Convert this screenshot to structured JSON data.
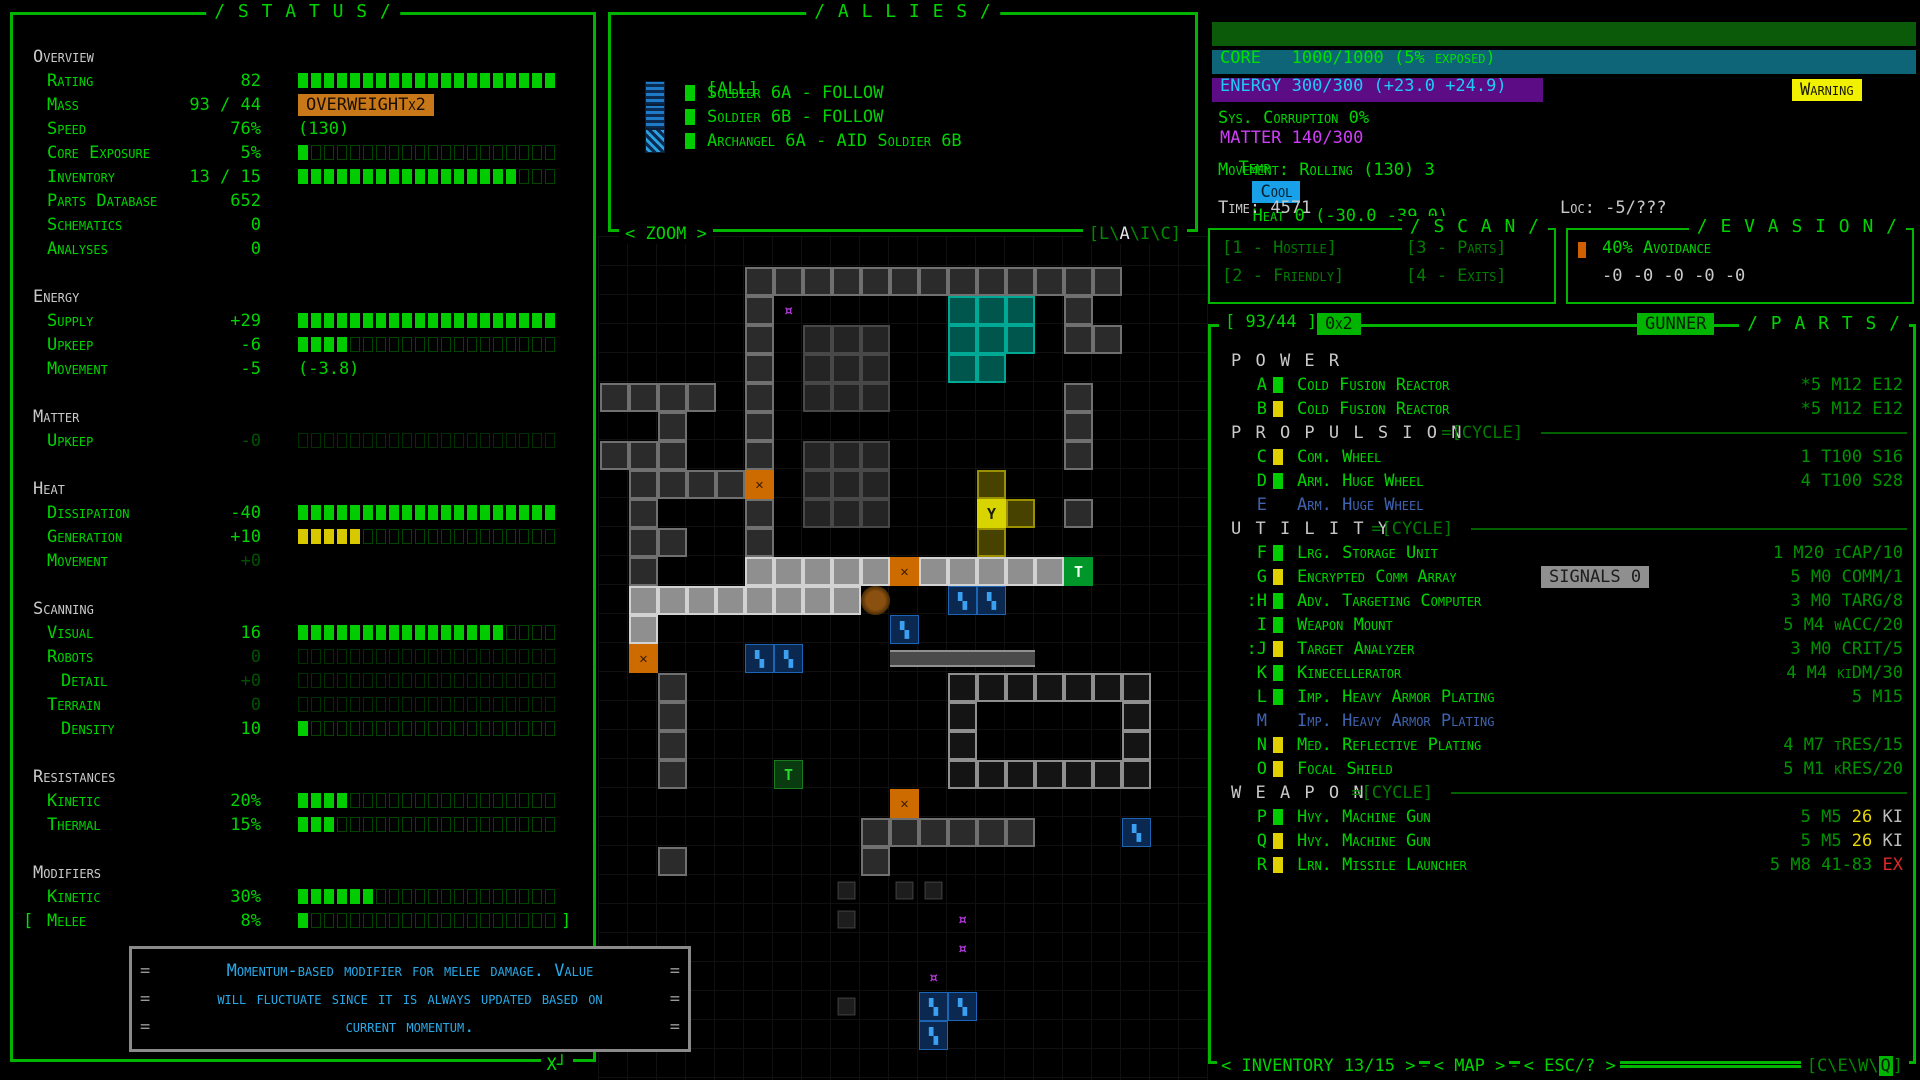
{
  "status": {
    "title": "/ S T A T U S /",
    "close_label": "X┘",
    "rows": [
      {
        "type": "header",
        "label": "Overview"
      },
      {
        "type": "stat",
        "label": "Rating",
        "value": "82",
        "bar": {
          "filled": 20,
          "color": "green"
        }
      },
      {
        "type": "stat",
        "label": "Mass",
        "value": "93 / 44",
        "badge": {
          "text": "OVERWEIGHTx2",
          "style": "orange"
        }
      },
      {
        "type": "stat",
        "label": "Speed",
        "value": "76%",
        "suffix": "(130)"
      },
      {
        "type": "stat",
        "label": "Core Exposure",
        "value": "5%",
        "bar": {
          "filled": 1,
          "color": "green"
        }
      },
      {
        "type": "stat",
        "label": "Inventory",
        "value": "13 / 15",
        "bar": {
          "filled": 17,
          "color": "green"
        }
      },
      {
        "type": "stat",
        "label": "Parts Database",
        "value": "652"
      },
      {
        "type": "stat",
        "label": "Schematics",
        "value": "0"
      },
      {
        "type": "stat",
        "label": "Analyses",
        "value": "0"
      },
      {
        "type": "gap"
      },
      {
        "type": "header",
        "label": "Energy"
      },
      {
        "type": "stat",
        "label": "Supply",
        "value": "+29",
        "bar": {
          "filled": 20,
          "color": "green"
        }
      },
      {
        "type": "stat",
        "label": "Upkeep",
        "value": "-6",
        "bar": {
          "filled": 4,
          "color": "green"
        }
      },
      {
        "type": "stat",
        "label": "Movement",
        "value": "-5",
        "suffix": "(-3.8)"
      },
      {
        "type": "gap"
      },
      {
        "type": "header",
        "label": "Matter"
      },
      {
        "type": "stat",
        "label": "Upkeep",
        "value": "-0",
        "dimval": true,
        "bar": {
          "filled": 0,
          "color": "green",
          "dim": true
        }
      },
      {
        "type": "gap"
      },
      {
        "type": "header",
        "label": "Heat"
      },
      {
        "type": "stat",
        "label": "Dissipation",
        "value": "-40",
        "bar": {
          "filled": 20,
          "color": "green"
        }
      },
      {
        "type": "stat",
        "label": "Generation",
        "value": "+10",
        "bar": {
          "filled": 5,
          "color": "yellow"
        }
      },
      {
        "type": "stat",
        "label": "Movement",
        "value": "+0",
        "dimval": true
      },
      {
        "type": "gap"
      },
      {
        "type": "header",
        "label": "Scanning"
      },
      {
        "type": "stat",
        "label": "Visual",
        "value": "16",
        "bar": {
          "filled": 16,
          "color": "green"
        }
      },
      {
        "type": "stat",
        "label": "Robots",
        "value": "0",
        "dimval": true,
        "bar": {
          "filled": 0,
          "color": "green",
          "dim": true
        }
      },
      {
        "type": "stat",
        "label": "Detail",
        "indent": true,
        "value": "+0",
        "dimval": true,
        "bar": {
          "filled": 0,
          "color": "green",
          "dim": true
        }
      },
      {
        "type": "stat",
        "label": "Terrain",
        "value": "0",
        "dimval": true,
        "bar": {
          "filled": 0,
          "color": "green",
          "dim": true
        }
      },
      {
        "type": "stat",
        "label": "Density",
        "indent": true,
        "value": "10",
        "bar": {
          "filled": 1,
          "color": "green"
        }
      },
      {
        "type": "gap"
      },
      {
        "type": "header",
        "label": "Resistances"
      },
      {
        "type": "stat",
        "label": "Kinetic",
        "value": "20%",
        "bar": {
          "filled": 4,
          "color": "green"
        }
      },
      {
        "type": "stat",
        "label": "Thermal",
        "value": "15%",
        "bar": {
          "filled": 3,
          "color": "green"
        }
      },
      {
        "type": "gap"
      },
      {
        "type": "header",
        "label": "Modifiers"
      },
      {
        "type": "stat",
        "label": "Kinetic",
        "value": "30%",
        "bar": {
          "filled": 6,
          "color": "green"
        }
      },
      {
        "type": "stat",
        "label": "Melee",
        "value": "8%",
        "bar": {
          "filled": 1,
          "color": "green"
        },
        "bracketed": true
      }
    ],
    "tooltip": {
      "tick": "=",
      "lines": [
        "Momentum-based modifier for melee damage. Value",
        "will fluctuate since it is always updated based on",
        "current momentum."
      ]
    }
  },
  "allies": {
    "title": "/ A L L I E S /",
    "all_label": "[ALL]",
    "rows": [
      {
        "name": "Soldier 6A - FOLLOW",
        "sprite": "soldier"
      },
      {
        "name": "Soldier 6B - FOLLOW",
        "sprite": "soldier"
      },
      {
        "name": "Archangel 6A - AID Soldier 6B",
        "sprite": "archangel"
      }
    ],
    "zoom_label": "< ZOOM >",
    "modes": {
      "open": "[",
      "close": "]",
      "sep": "\\",
      "letters": [
        {
          "ch": "L",
          "active": false
        },
        {
          "ch": "A",
          "active": true
        },
        {
          "ch": "I",
          "active": false
        },
        {
          "ch": "C",
          "active": false
        }
      ]
    }
  },
  "hud": {
    "core": {
      "label": "CORE",
      "value": "1000/1000 (5% exposed)",
      "fill_pct": 100
    },
    "energy": {
      "label": "ENERGY",
      "value": "300/300 (+23.0 +24.9)",
      "fill_pct": 100
    },
    "matter": {
      "label": "MATTER",
      "value": "140/300",
      "fill_pct": 47
    },
    "warning": "Warning",
    "corruption": "Sys. Corruption 0%",
    "temp_label": "Temp",
    "temp_badge": "Cool",
    "heat": "Heat 0 (-30.0 -39.0)",
    "movement": "Movement: Rolling (130) 3",
    "time": "Time: 4571",
    "loc": "Loc: -5/???"
  },
  "scan": {
    "title": "/ S C A N /",
    "options": [
      "[1 - Hostile]",
      "[3 - Parts]",
      "[2 - Friendly]",
      "[4 - Exits]"
    ]
  },
  "evasion": {
    "title": "/ E V A S I O N /",
    "avoidance": "40% Avoidance",
    "values": "-0 -0 -0 -0 -0"
  },
  "parts": {
    "header": {
      "mass": "[ 93/44 ]",
      "mult": "0x2",
      "mode": "GUNNER",
      "title": "/ P A R T S /"
    },
    "rows": [
      {
        "type": "section",
        "label": "P O W E R",
        "cycle": false
      },
      {
        "type": "part",
        "letter": "A",
        "block": "green",
        "name": "Cold Fusion Reactor",
        "stats": [
          {
            "t": "*5 M12 E12",
            "c": "dim"
          }
        ]
      },
      {
        "type": "part",
        "letter": "B",
        "block": "yellow",
        "name": "Cold Fusion Reactor",
        "stats": [
          {
            "t": "*5 M12 E12",
            "c": "dim"
          }
        ]
      },
      {
        "type": "section",
        "label": "P R O P U L S I O N",
        "cycle": true,
        "cycle_label": "=[CYCLE]",
        "line_from": 330
      },
      {
        "type": "part",
        "letter": "C",
        "block": "yellow",
        "name": "Com. Wheel",
        "stats": [
          {
            "t": "1 T100 S16",
            "c": "dim"
          }
        ]
      },
      {
        "type": "part",
        "letter": "D",
        "block": "green",
        "name": "Arm. Huge Wheel",
        "stats": [
          {
            "t": "4 T100 S28",
            "c": "dim"
          }
        ]
      },
      {
        "type": "part",
        "letter": "E",
        "block": null,
        "name": "Arm. Huge Wheel",
        "inactive": true,
        "stats": []
      },
      {
        "type": "section",
        "label": "U T I L I T Y",
        "cycle": true,
        "cycle_label": "=[CYCLE]",
        "line_from": 260
      },
      {
        "type": "part",
        "letter": "F",
        "block": "green",
        "name": "Lrg. Storage Unit",
        "stats": [
          {
            "t": "1 M20 iCAP/10",
            "c": "dim"
          }
        ]
      },
      {
        "type": "part",
        "letter": "G",
        "block": "yellow",
        "name": "Encrypted Comm Array",
        "badge": "SIGNALS 0",
        "stats": [
          {
            "t": "5 M0 COMM/1",
            "c": "dim"
          }
        ]
      },
      {
        "type": "part",
        "letter": "H",
        "prefix": ":",
        "block": "green",
        "name": "Adv. Targeting Computer",
        "stats": [
          {
            "t": "3 M0 TARG/8",
            "c": "dim"
          }
        ]
      },
      {
        "type": "part",
        "letter": "I",
        "block": "green",
        "name": "Weapon Mount",
        "stats": [
          {
            "t": "5 M4 wACC/20",
            "c": "dim"
          }
        ]
      },
      {
        "type": "part",
        "letter": "J",
        "prefix": ":",
        "block": "yellow",
        "name": "Target Analyzer",
        "stats": [
          {
            "t": "3 M0 CRIT/5",
            "c": "dim"
          }
        ]
      },
      {
        "type": "part",
        "letter": "K",
        "block": "green",
        "name": "Kinecellerator",
        "stats": [
          {
            "t": "4 M4 kiDM/30",
            "c": "dim"
          }
        ]
      },
      {
        "type": "part",
        "letter": "L",
        "block": "green",
        "name": "Imp. Heavy Armor Plating",
        "stats": [
          {
            "t": "5 M15",
            "c": "dim"
          }
        ]
      },
      {
        "type": "part",
        "letter": "M",
        "block": null,
        "name": "Imp. Heavy Armor Plating",
        "inactive": true,
        "stats": []
      },
      {
        "type": "part",
        "letter": "N",
        "block": "yellow",
        "name": "Med. Reflective Plating",
        "stats": [
          {
            "t": "4 M7 tRES/15",
            "c": "dim"
          }
        ]
      },
      {
        "type": "part",
        "letter": "O",
        "block": "yellow",
        "name": "Focal Shield",
        "stats": [
          {
            "t": "5 M1 kRES/20",
            "c": "dim"
          }
        ]
      },
      {
        "type": "section",
        "label": "W E A P O N",
        "cycle": true,
        "cycle_label": "=[CYCLE]",
        "line_from": 240
      },
      {
        "type": "part",
        "letter": "P",
        "block": "green",
        "name": "Hvy. Machine Gun",
        "stats": [
          {
            "t": "5 M5 ",
            "c": "dim"
          },
          {
            "t": "26",
            "c": "yellow"
          },
          {
            "t": " KI",
            "c": "gray"
          }
        ]
      },
      {
        "type": "part",
        "letter": "Q",
        "block": "yellow",
        "name": "Hvy. Machine Gun",
        "stats": [
          {
            "t": "5 M5 ",
            "c": "dim"
          },
          {
            "t": "26",
            "c": "yellow"
          },
          {
            "t": " KI",
            "c": "gray"
          }
        ]
      },
      {
        "type": "part",
        "letter": "R",
        "block": "yellow",
        "name": "Lrn. Missile Launcher",
        "stats": [
          {
            "t": "5 M8 41-83 ",
            "c": "dim"
          },
          {
            "t": "EX",
            "c": "red"
          }
        ]
      }
    ],
    "footer": {
      "buttons": [
        "< INVENTORY 13/15 >",
        "< MAP >",
        "< ESC/? >"
      ],
      "sep": "-",
      "modes": {
        "open": "[",
        "close": "]",
        "sep": "\\",
        "letters": [
          {
            "ch": "C",
            "active": false
          },
          {
            "ch": "E",
            "active": false
          },
          {
            "ch": "W",
            "active": false
          },
          {
            "ch": "Q",
            "active": true
          }
        ]
      }
    }
  },
  "map": {
    "tile": 29,
    "rows": [
      ".....................",
      ".....#############...",
      ".....#P.....TTT.#....",
      ".....#.MMM..TTT.##...",
      ".....#.MMM..TT.......",
      "####.#.MMM......#....",
      "..#..#..........#....",
      "###..#.MMM......#....",
      ".####O.MMM...y.......",
      ".#...#.MMM...Yy.#....",
      ".##..#.......y.......",
      ".#...WWWWWOWWWWWE....",
      ".WWWWWWWWo..BB.......",
      ".W........B..........",
      ".O...BB...ggggg......",
      "..#.........wwwwwww..",
      "..#.........w.....w..",
      "..#.........w.....w..",
      "..#...G.....wwwwwww..",
      "..........O..........",
      ".........######...B..",
      "..#......#...........",
      "........m.mm.........",
      "........m...P........",
      "............P........",
      "...........P.........",
      "........m..BB........",
      "...........B.........",
      "....................."
    ],
    "legend": {
      "#": {
        "type": "wall",
        "interact": false
      },
      "W": {
        "type": "wall-bright",
        "interact": false
      },
      "w": {
        "type": "wall-mid",
        "interact": false
      },
      "M": {
        "type": "machine",
        "interact": false
      },
      "m": {
        "type": "machine-small",
        "interact": false
      },
      "T": {
        "type": "machine-teal",
        "interact": false
      },
      "y": {
        "type": "machine-olive",
        "interact": false
      },
      "Y": {
        "type": "robot-yellow",
        "ch": "Y",
        "interact": true
      },
      "O": {
        "type": "item-crate",
        "ch": "✕",
        "interact": true
      },
      "o": {
        "type": "creature-brown",
        "interact": true
      },
      "B": {
        "type": "robot-blue",
        "ch": "▚",
        "interact": true
      },
      "G": {
        "type": "player",
        "ch": "T",
        "interact": true
      },
      "E": {
        "type": "exit-green",
        "ch": "T",
        "interact": true
      },
      "P": {
        "type": "item-purple",
        "ch": "¤",
        "interact": true
      },
      "g": {
        "type": "conveyor",
        "interact": false
      }
    }
  }
}
